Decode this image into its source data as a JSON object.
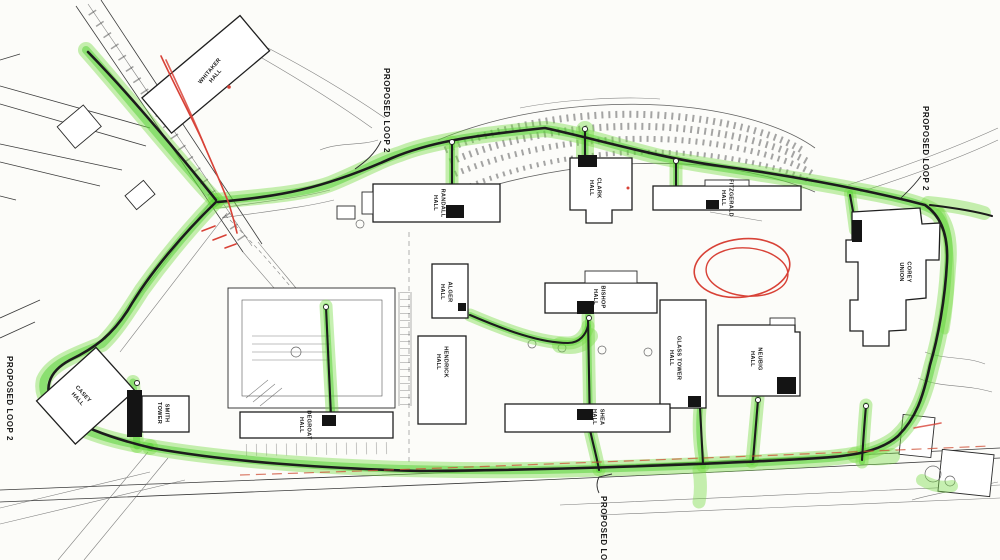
{
  "annotations": {
    "proposed_loop_label": "PROPOSED LOOP 2"
  },
  "buildings": [
    {
      "id": "whitaker",
      "line1": "WHITAKER",
      "line2": "HALL"
    },
    {
      "id": "randall",
      "line1": "RANDALL",
      "line2": "HALL"
    },
    {
      "id": "clark",
      "line1": "CLARK",
      "line2": "HALL"
    },
    {
      "id": "fitzgerald",
      "line1": "FITZGERALD",
      "line2": "HALL"
    },
    {
      "id": "corey-union",
      "line1": "COREY",
      "line2": "UNION"
    },
    {
      "id": "alger",
      "line1": "ALGER",
      "line2": "HALL"
    },
    {
      "id": "hendrick",
      "line1": "HENDRICK",
      "line2": "HALL"
    },
    {
      "id": "bishop",
      "line1": "BISHOP",
      "line2": "HALL"
    },
    {
      "id": "glass-tower",
      "line1": "GLASS TOWER",
      "line2": "HALL"
    },
    {
      "id": "neubig",
      "line1": "NEUBIG",
      "line2": "HALL"
    },
    {
      "id": "shea",
      "line1": "SHEA",
      "line2": "HALL"
    },
    {
      "id": "casey",
      "line1": "CASEY",
      "line2": "HALL"
    },
    {
      "id": "smith-tower",
      "line1": "SMITH",
      "line2": "TOWER"
    },
    {
      "id": "degroat",
      "line1": "DEGROAT",
      "line2": "HALL"
    }
  ],
  "colors": {
    "highlighter_green": "#6fdb3f",
    "utility_line": "#1c1c1c",
    "annotation_red": "#d84237",
    "road_orange_red": "#cf4f35",
    "paper": "#fcfcf9",
    "linework": "#3c3c3c"
  }
}
